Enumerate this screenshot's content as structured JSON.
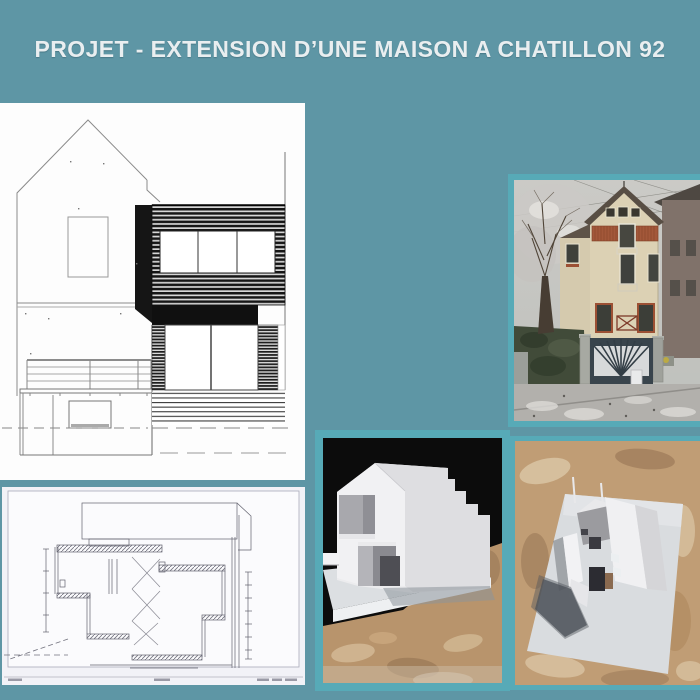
{
  "title": "PROJET - EXTENSION D’UNE MAISON A CHATILLON 92",
  "colors": {
    "page_background": "#5e96a5",
    "photo_frame_teal": "#57aab7",
    "title_text": "#e9eef0",
    "drawing_paper_white": "#fdfdfd",
    "section_paper": "#f2f2f7",
    "extension_cladding_dark": "#151515",
    "facade_cream": "#dcd1b4",
    "brick_red": "#a3583a",
    "osb_board_tan": "#c09d75",
    "model_card_white": "#ececee",
    "photo_black_background": "#0c0c0c"
  },
  "figures": {
    "elevation": "elevation-drawing-extension",
    "section": "section-drawing",
    "house_photo": "existing-house-photo",
    "model_front_photo": "model-photo-front-view",
    "model_aerial_photo": "model-photo-aerial-view"
  }
}
